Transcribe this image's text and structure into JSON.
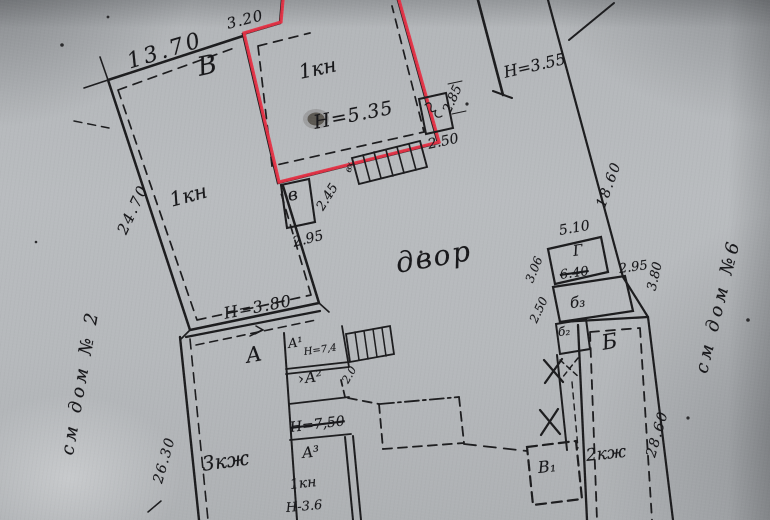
{
  "document": {
    "kind": "scanned cadastral site plan",
    "language": "ru"
  },
  "colors": {
    "paper": "#b6b9bc",
    "ink": "#1c1c1e",
    "highlight_red": "#e73246"
  },
  "icons": {
    "entrance_chevron": "›"
  },
  "neighbors": {
    "left": "см дом № 2",
    "right": "см дом №6"
  },
  "courtyard_label": "двор",
  "building_v": {
    "letter": "В",
    "use": "1кн",
    "dim_top": "13.70",
    "dim_side": "24.70",
    "dim_step": "3.20",
    "height": "Н=3.80"
  },
  "building_main": {
    "use": "1кн",
    "height": "Н=5.35",
    "entrance": "вх",
    "annex": {
      "letter": "в",
      "dim_bottom": "2.95",
      "dim_side": "2.45"
    },
    "porch": {
      "dim_side": "2.85",
      "dim_bottom": "2.50"
    }
  },
  "building_ne": {
    "height": "Н=3.55"
  },
  "boundaries": {
    "east_upper": "18.60",
    "east_mid": "3.80",
    "east_lower": "28.60"
  },
  "structure_g": {
    "letter": "Г",
    "dim_top": "5.10",
    "dim_side": "3.06",
    "dim_side2": "2.50",
    "dim_struck": "6.40"
  },
  "building_b": {
    "letter": "Б",
    "use": "2кж",
    "b3": "б₃",
    "b2": "б₂",
    "dim_top": "2.95"
  },
  "shed_v1": {
    "letter": "В₁"
  },
  "building_a": {
    "letter": "А",
    "use": "3кж",
    "dim_side": "26.30",
    "a1": {
      "letter": "А¹",
      "height": "Н=7,4"
    },
    "a2": {
      "letter": "А²",
      "height_struck": "Н=7,50"
    },
    "a3": {
      "letter": "А³",
      "use": "1кн",
      "height": "Н-3.6"
    },
    "stair_dim": "2.0"
  }
}
